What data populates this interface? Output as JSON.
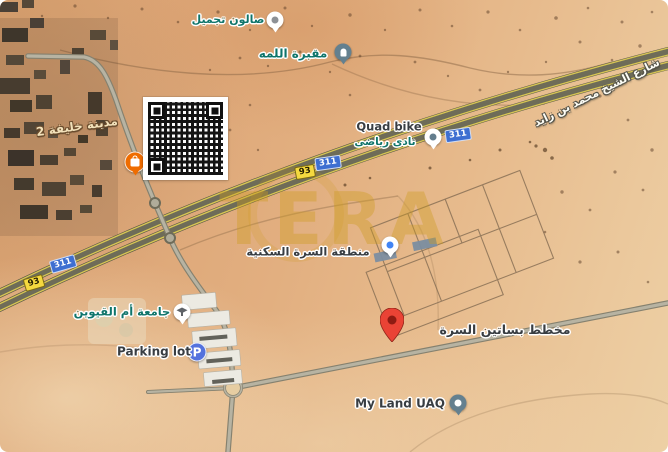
{
  "watermark": {
    "text": "TERA"
  },
  "road": {
    "name": "شارع الشيخ محمد بن زايد"
  },
  "badges": {
    "e311": "311",
    "r93": "93"
  },
  "colors": {
    "label_teal": "#0f756b",
    "label_dark": "#383d42",
    "badge_blue": "#3e6fd1",
    "badge_yellow": "#f4d93f",
    "pin_red": "#ea4335",
    "pin_slate": "#64808f",
    "parking_blue": "#5472dd",
    "store_orange": "#ef6c00",
    "watermark_gold": "#ce9c1c"
  },
  "places": {
    "beauty_salon": {
      "label": "صالون تجميل"
    },
    "lamha_cemetery": {
      "label": "مقبرة اللمه"
    },
    "khalifa_city_2": {
      "label": "مدينة خليفة 2"
    },
    "quad_bike": {
      "label": "Quad bike",
      "sublabel": "نادى رياضى"
    },
    "surra_residential": {
      "label": "منطقة السرة السكنية"
    },
    "uaq_university": {
      "label": "جامعة أم القيوين"
    },
    "parking_lot": {
      "label": "Parking lot",
      "icon_letter": "P"
    },
    "basateen_surra_plan": {
      "label": "مخطط بساتين السرة"
    },
    "my_land_uaq": {
      "label": "My Land UAQ"
    }
  }
}
